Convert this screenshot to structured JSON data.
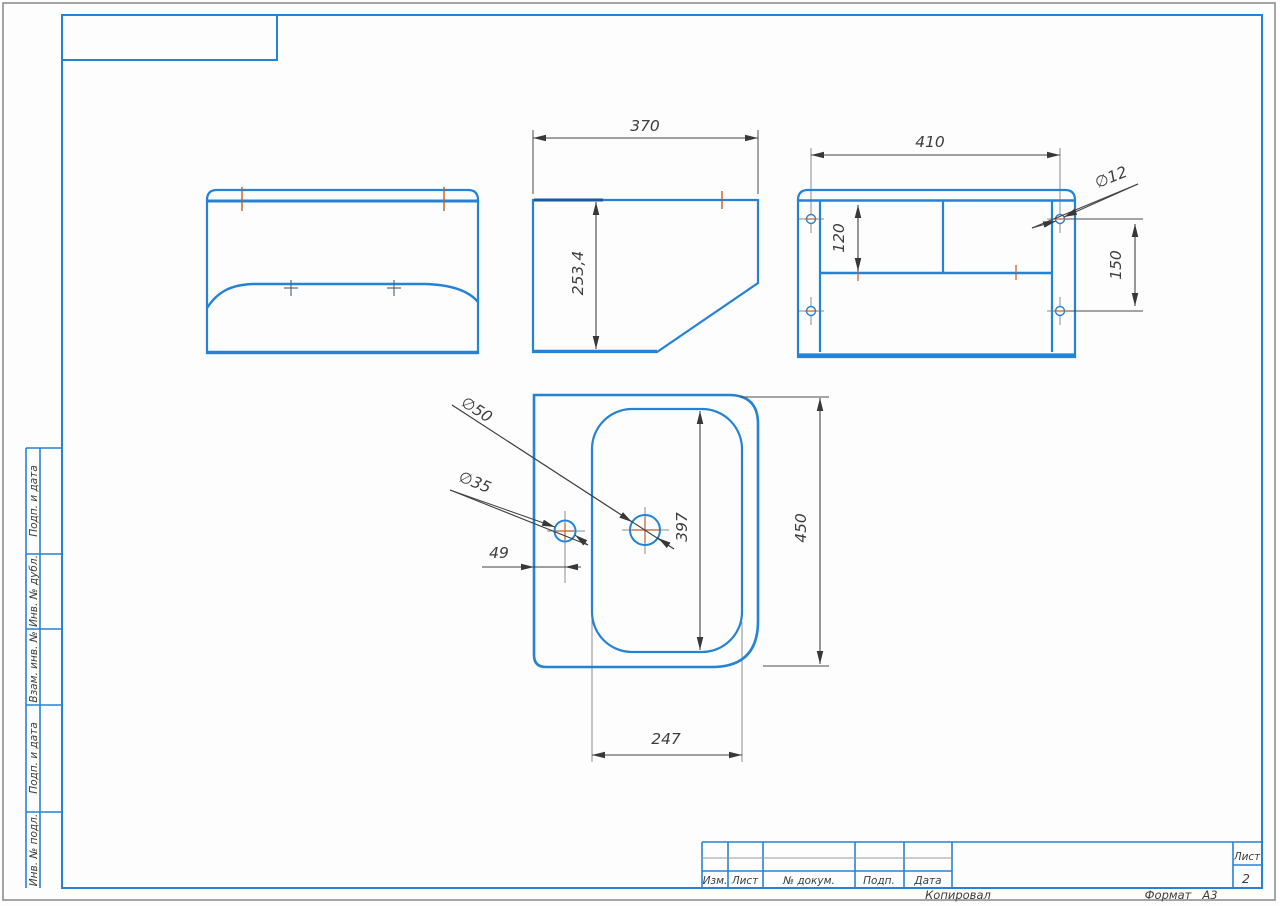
{
  "page": {
    "sidebar": {
      "cells": [
        {
          "label": "Подп. и дата"
        },
        {
          "label": "Инв. № дубл."
        },
        {
          "label": "Взам. инв. №"
        },
        {
          "label": "Подп. и дата"
        },
        {
          "label": "Инв. № подл."
        }
      ]
    },
    "title_block": {
      "columns": [
        {
          "label": "Изм."
        },
        {
          "label": "Лист"
        },
        {
          "label": "№ докум."
        },
        {
          "label": "Подп."
        },
        {
          "label": "Дата"
        }
      ],
      "sheet_label": "Лист",
      "sheet_number": "2"
    },
    "footer": {
      "copied_by": "Копировал",
      "format_label": "Формат",
      "format_value": "А3"
    }
  },
  "drawing": {
    "dimensions": {
      "side_view": {
        "width": "370",
        "height": "253,4"
      },
      "back_view": {
        "mount_hole_spacing_h": "410",
        "panel_top_offset": "120",
        "mount_hole_diameter": "∅12",
        "mount_hole_spacing_v": "150"
      },
      "top_view": {
        "drain_hole_diameter": "∅50",
        "faucet_hole_diameter": "∅35",
        "faucet_hole_offset": "49",
        "basin_inner_length": "397",
        "overall_depth": "450",
        "basin_inner_width": "247"
      }
    },
    "colors": {
      "line_blue": "#2483d5",
      "line_navy": "#17599e",
      "centerline_orange": "#c25b2a",
      "dimension_dark": "#424242",
      "extension_gray": "#8a8a8a",
      "border_gray": "#8f8f8f"
    }
  }
}
